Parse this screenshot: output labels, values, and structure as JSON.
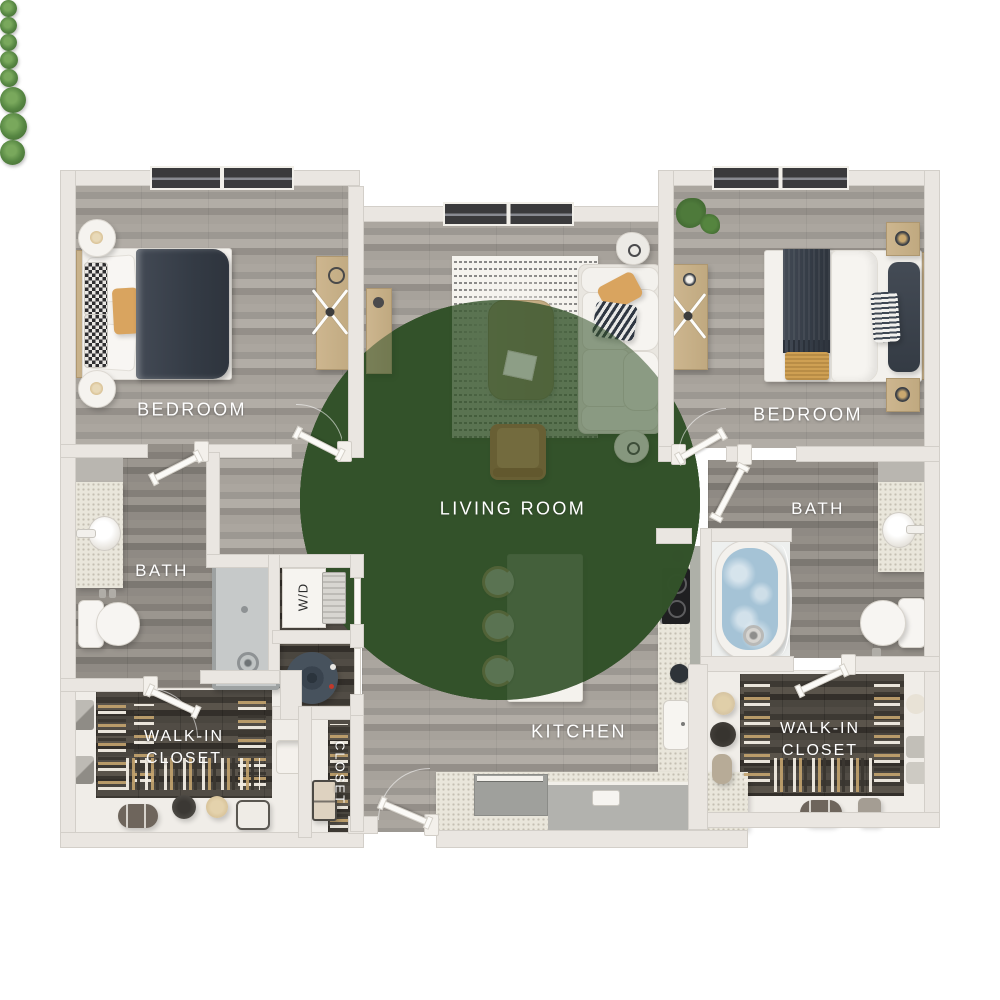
{
  "app": {
    "type": "floor-plan",
    "description": "Two-bedroom, two-bath apartment floor plan, top-down 3D render"
  },
  "labels": {
    "bedroom_left": "BEDROOM",
    "bedroom_right": "BEDROOM",
    "living_room": "LIVING ROOM",
    "kitchen": "KITCHEN",
    "bath_left": "BATH",
    "bath_right": "BATH",
    "walk_in_closet_left": {
      "line1": "WALK-IN",
      "line2": "CLOSET"
    },
    "walk_in_closet_right": {
      "line1": "WALK-IN",
      "line2": "CLOSET"
    },
    "closet": "CLOSET",
    "washer_dryer": "W/D"
  },
  "colors": {
    "background": "#ffffff",
    "wall": "#eae6e1",
    "floor_wood_light": "#a49f99",
    "floor_wood_mid": "#8d8982",
    "floor_wood_dark": "#47433d",
    "counter_speckle": "#e9e6db",
    "island_white": "#f4f2ed",
    "bed_navy": "#3a414b",
    "accent_tan": "#d9a45f",
    "accent_mustard": "#cfa053",
    "tub_water_blue": "#a5c3d6",
    "shower_gray": "#c6c9c9",
    "sofa_white": "#f1efeb",
    "armchair_leather": "#b57b4d",
    "plant_green": "#5c8f46",
    "label_text": "#ffffff",
    "window_glass": "#3a3a3c"
  }
}
